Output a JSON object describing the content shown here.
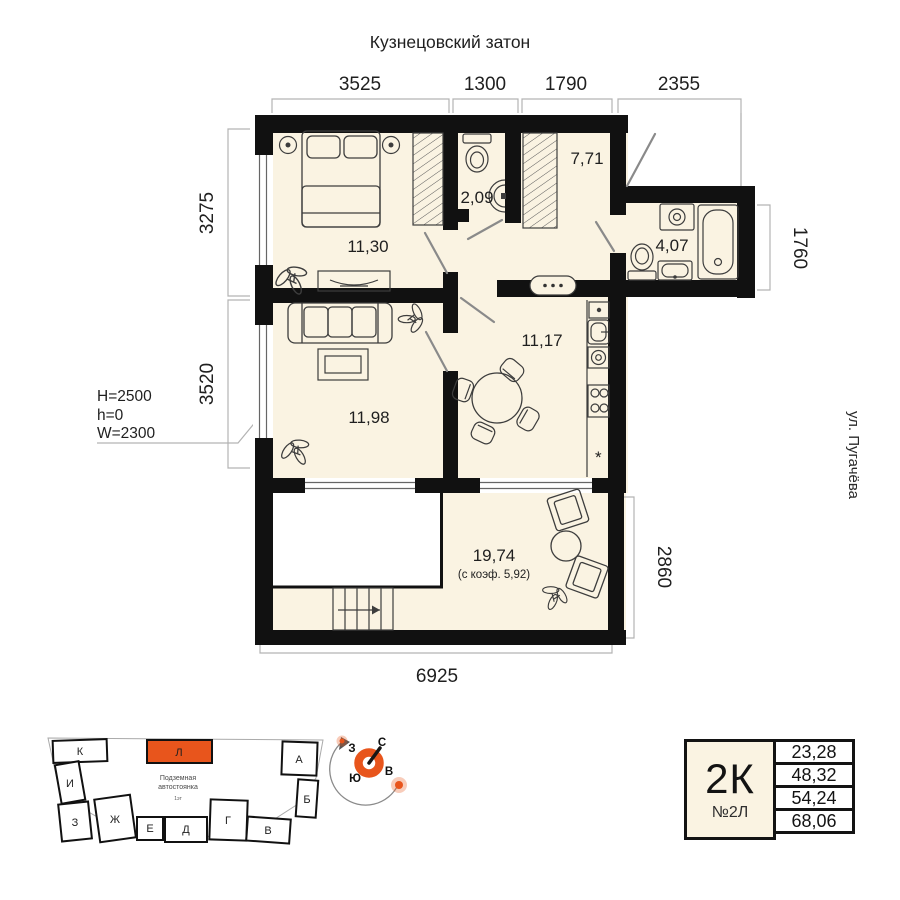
{
  "header": {
    "title": "Кузнецовский затон"
  },
  "street": {
    "label": "ул. Пугачёва"
  },
  "dims": {
    "top": [
      "3525",
      "1300",
      "1790",
      "2355"
    ],
    "left_upper": "3275",
    "left_lower": "3520",
    "right_bath": "1760",
    "right_terrace": "2860",
    "bottom": "6925"
  },
  "ceiling_note": {
    "line1": "H=2500",
    "line2": "h=0",
    "line3": "W=2300"
  },
  "rooms": {
    "bedroom": "11,30",
    "wc": "2,09",
    "hallway": "7,71",
    "bathroom": "4,07",
    "kitchen": "11,17",
    "living": "11,98",
    "terrace": "19,74",
    "terrace_note": "(с коэф. 5,92)"
  },
  "kitchen": {
    "star": "*"
  },
  "site_plan": {
    "parking_line1": "Подземная",
    "parking_line2": "автостоянка",
    "parking_sub": "1эт",
    "blocks": {
      "k": "К",
      "i": "И",
      "z": "З",
      "zh": "Ж",
      "e": "Е",
      "d": "Д",
      "g": "Г",
      "v": "В",
      "a": "А",
      "b": "Б",
      "l": "Л"
    },
    "highlighted_block": "Л"
  },
  "compass": {
    "n": "С",
    "e": "В",
    "s": "Ю",
    "w": "З"
  },
  "card": {
    "type": "2К",
    "number": "№2Л",
    "rows": [
      "23,28",
      "48,32",
      "54,24",
      "68,06"
    ]
  },
  "colors": {
    "floor": "#faf3e2",
    "wall": "#111111",
    "accent": "#e8551c"
  }
}
